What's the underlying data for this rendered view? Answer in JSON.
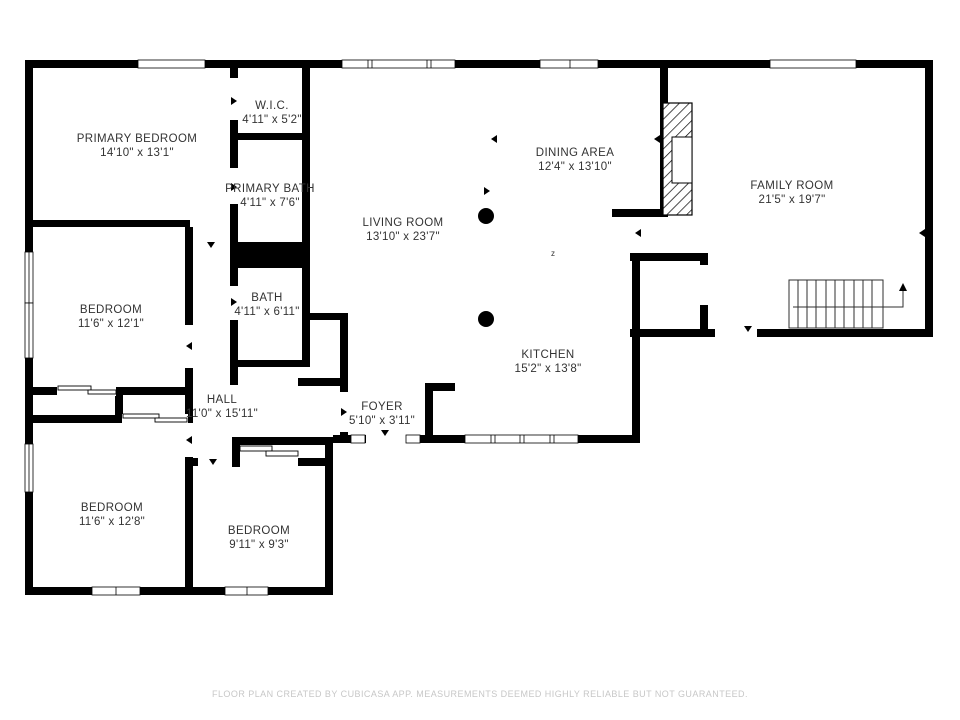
{
  "rooms": [
    {
      "name": "PRIMARY BEDROOM",
      "dims": "14'10\" x 13'1\""
    },
    {
      "name": "W.I.C.",
      "dims": "4'11\" x 5'2\""
    },
    {
      "name": "PRIMARY BATH",
      "dims": "4'11\" x 7'6\""
    },
    {
      "name": "BATH",
      "dims": "4'11\" x 6'11\""
    },
    {
      "name": "BEDROOM",
      "dims": "11'6\" x 12'1\""
    },
    {
      "name": "HALL",
      "dims": "11'0\" x 15'11\""
    },
    {
      "name": "BEDROOM",
      "dims": "11'6\" x 12'8\""
    },
    {
      "name": "BEDROOM",
      "dims": "9'11\" x 9'3\""
    },
    {
      "name": "FOYER",
      "dims": "5'10\" x 3'11\""
    },
    {
      "name": "LIVING ROOM",
      "dims": "13'10\" x 23'7\""
    },
    {
      "name": "DINING AREA",
      "dims": "12'4\" x 13'10\""
    },
    {
      "name": "KITCHEN",
      "dims": "15'2\" x 13'8\""
    },
    {
      "name": "FAMILY ROOM",
      "dims": "21'5\" x 19'7\""
    }
  ],
  "annotations": {
    "compass_mark": "z"
  },
  "colors": {
    "wall": "#000000",
    "label": "#333333",
    "footer": "#c7c7c7",
    "background": "#ffffff"
  },
  "footer": {
    "text": "FLOOR PLAN CREATED BY CUBICASA APP. MEASUREMENTS DEEMED HIGHLY RELIABLE BUT NOT GUARANTEED."
  }
}
